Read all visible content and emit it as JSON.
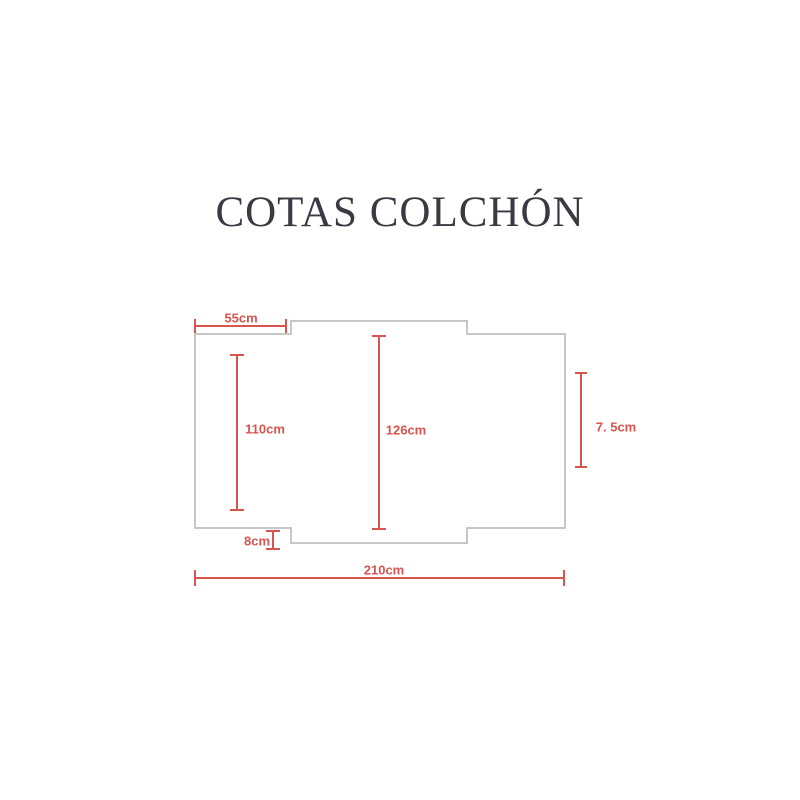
{
  "title": "COTAS COLCHÓN",
  "colors": {
    "dimension_red": "#d9534f",
    "outline_gray": "#c7c7c7",
    "title_color": "#3a3a44",
    "background": "#ffffff"
  },
  "diagram": {
    "dimensions": [
      {
        "id": "left-flap-width",
        "label": "55cm",
        "value": 55,
        "unit": "cm"
      },
      {
        "id": "left-section-height",
        "label": "110cm",
        "value": 110,
        "unit": "cm"
      },
      {
        "id": "center-section-height",
        "label": "126cm",
        "value": 126,
        "unit": "cm"
      },
      {
        "id": "right-side-depth",
        "label": "7. 5cm",
        "value": 7.5,
        "unit": "cm"
      },
      {
        "id": "bottom-step-height",
        "label": "8cm",
        "value": 8,
        "unit": "cm"
      },
      {
        "id": "total-width",
        "label": "210cm",
        "value": 210,
        "unit": "cm"
      }
    ]
  }
}
